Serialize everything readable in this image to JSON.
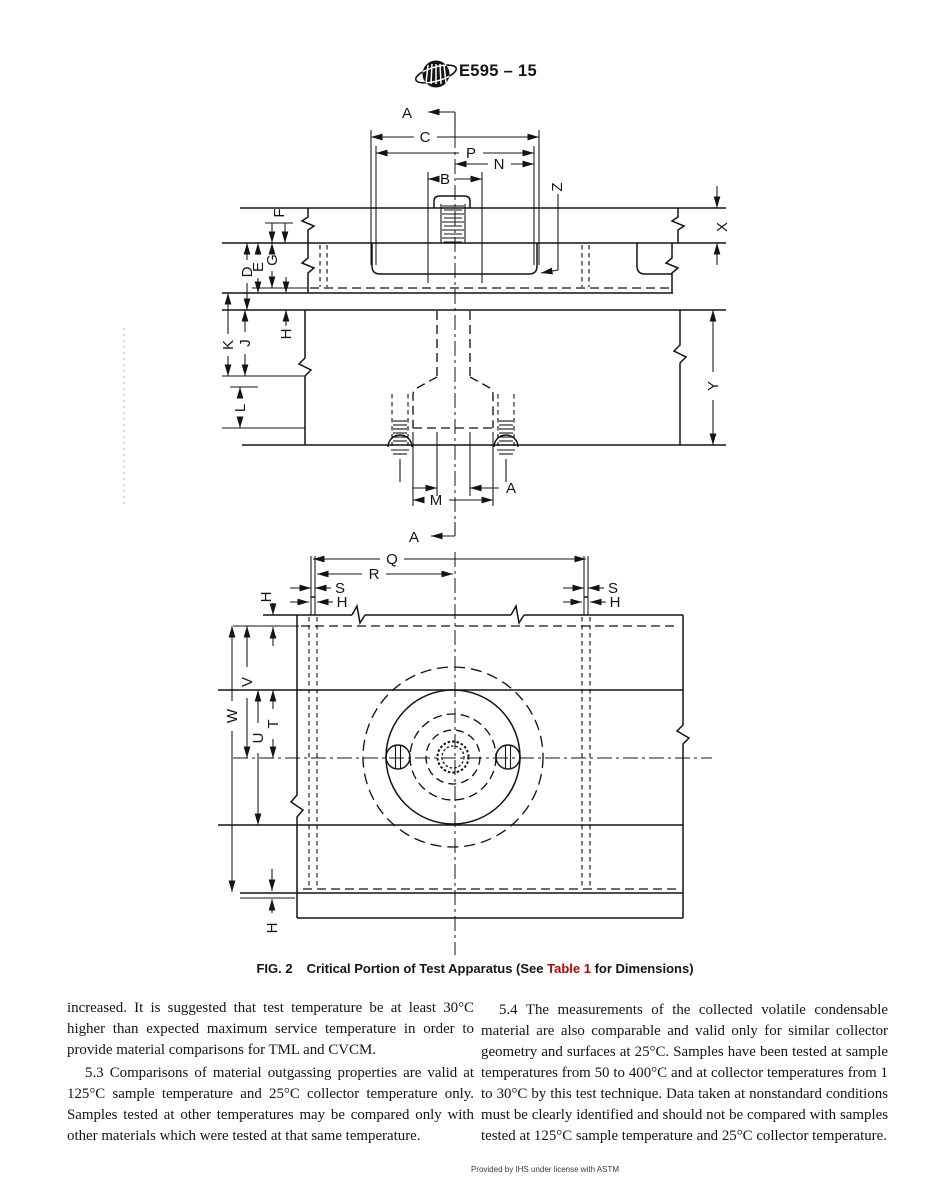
{
  "header": {
    "title": "E595 – 15",
    "logo": "astm-logo"
  },
  "figure": {
    "section_label": "A",
    "dim_labels": {
      "A": "A",
      "B": "B",
      "C": "C",
      "D": "D",
      "E": "E",
      "F": "F",
      "G": "G",
      "H": "H",
      "J": "J",
      "K": "K",
      "L": "L",
      "M": "M",
      "N": "N",
      "P": "P",
      "Q": "Q",
      "R": "R",
      "S": "S",
      "T": "T",
      "U": "U",
      "V": "V",
      "W": "W",
      "X": "X",
      "Y": "Y",
      "Z": "Z"
    },
    "caption": {
      "fig_label": "FIG. 2",
      "before_link": "Critical Portion of Test Apparatus (See ",
      "link": "Table 1",
      "after_link": " for Dimensions)",
      "link_color": "#b30404"
    }
  },
  "body": {
    "left_column": [
      "increased. It is suggested that test temperature be at least 30°C higher than expected maximum service temperature in order to provide material comparisons for TML and CVCM.",
      "5.3 Comparisons of material outgassing properties are valid at 125°C sample temperature and 25°C collector temperature only. Samples tested at other temperatures may be compared only with other materials which were tested at that same temperature."
    ],
    "right_column": [
      "5.4 The measurements of the collected volatile condensable material are also comparable and valid only for similar collector geometry and surfaces at 25°C. Samples have been tested at sample temperatures from 50 to 400°C and at collector temperatures from 1 to 30°C by this test technique. Data taken at nonstandard conditions must be clearly identified and should not be compared with samples tested at 125°C sample temperature and 25°C collector temperature."
    ]
  },
  "footer": {
    "text": "Provided by IHS under license with ASTM"
  }
}
